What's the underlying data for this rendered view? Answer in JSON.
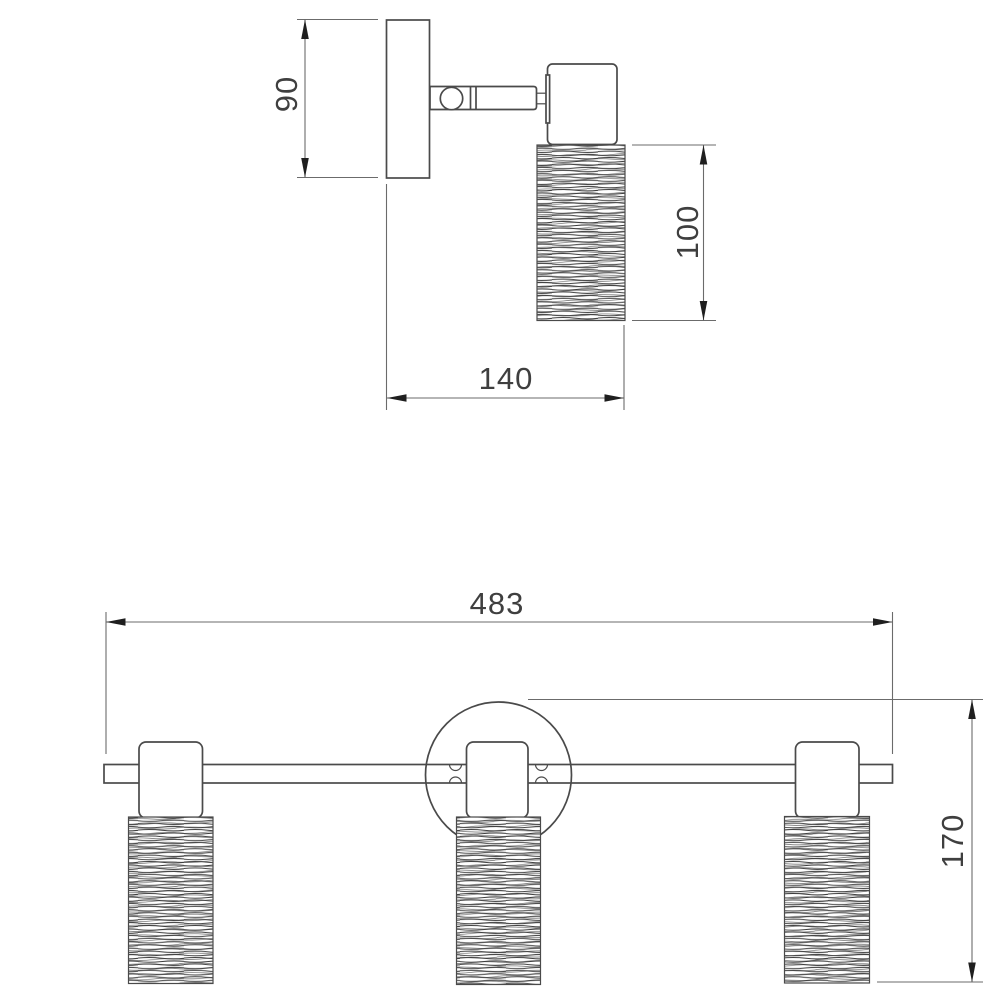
{
  "drawing": {
    "top_view": {
      "dim_plate_height": "90",
      "dim_shade_height": "100",
      "dim_depth": "140"
    },
    "front_view": {
      "dim_total_width": "483",
      "dim_total_height": "170"
    }
  },
  "colors": {
    "object-line": "#4a4a4a",
    "dim-line": "#6b6b6b",
    "arrow-fill": "#1f1f1f",
    "dim-text": "#3f3f3f",
    "hatch": "#3c3c3c",
    "background": "#ffffff"
  }
}
